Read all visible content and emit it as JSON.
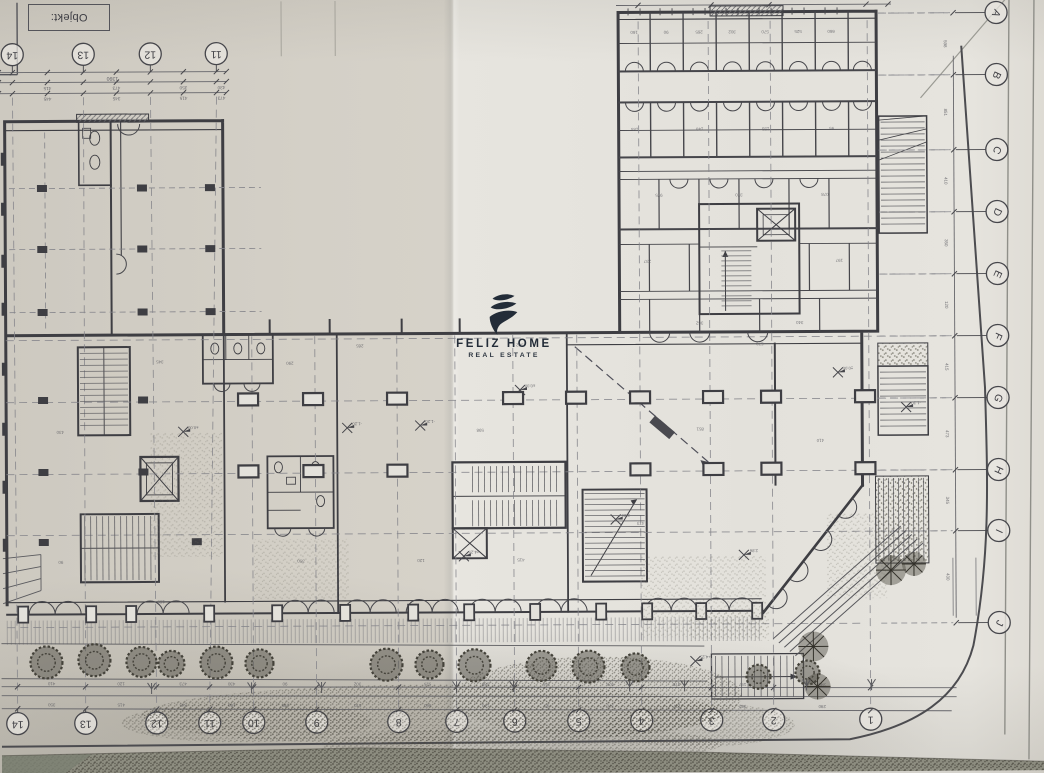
{
  "document": {
    "kind": "scanned architectural ground floor plan",
    "title_block": {
      "object_label": "Objekt:"
    },
    "watermark": {
      "line1": "FELIZ HOME",
      "line2": "REAL ESTATE"
    },
    "grid": {
      "top_columns": [
        {
          "label": "14",
          "x": 14
        },
        {
          "label": "13",
          "x": 85
        },
        {
          "label": "12",
          "x": 152
        },
        {
          "label": "11",
          "x": 218
        }
      ],
      "bottom_columns": [
        {
          "label": "14",
          "x": 16
        },
        {
          "label": "13",
          "x": 84
        },
        {
          "label": "12",
          "x": 155
        },
        {
          "label": "11",
          "x": 208
        },
        {
          "label": "10",
          "x": 252
        },
        {
          "label": "9",
          "x": 315
        },
        {
          "label": "8",
          "x": 397
        },
        {
          "label": "7",
          "x": 455
        },
        {
          "label": "6",
          "x": 513
        },
        {
          "label": "5",
          "x": 577
        },
        {
          "label": "4",
          "x": 640
        },
        {
          "label": "3",
          "x": 710
        },
        {
          "label": "2",
          "x": 772
        },
        {
          "label": "1",
          "x": 869
        }
      ],
      "rows": [
        {
          "label": "A",
          "y": 15
        },
        {
          "label": "B",
          "y": 77
        },
        {
          "label": "C",
          "y": 152
        },
        {
          "label": "D",
          "y": 214
        },
        {
          "label": "E",
          "y": 276
        },
        {
          "label": "F",
          "y": 338
        },
        {
          "label": "G",
          "y": 400
        },
        {
          "label": "H",
          "y": 472
        },
        {
          "label": "I",
          "y": 533
        },
        {
          "label": "J",
          "y": 625
        }
      ]
    },
    "dimensions": {
      "top_chain_total": "1390",
      "top_chain": [
        "415",
        "473",
        "350",
        "430",
        "445",
        "345"
      ],
      "scattered": [
        "410",
        "350",
        "120",
        "415",
        "473",
        "345",
        "430",
        "160",
        "90",
        "265",
        "302",
        "570",
        "525",
        "660",
        "185",
        "140",
        "155",
        "95",
        "975",
        "370",
        "078",
        "237",
        "197",
        "362",
        "340",
        "290",
        "598",
        "851"
      ],
      "levels": [
        "±0.00",
        "-1.20",
        "+4.25",
        "2.86"
      ]
    },
    "colors": {
      "paper_left": "#d4d0c7",
      "paper_right": "#e5e3dd",
      "ink": "#46464b",
      "ink_dark": "#3e3e43",
      "ink_light": "#84848a",
      "dim_text": "#5a5a60",
      "tree": "#44423a",
      "watermark": "#232c38",
      "table": "#8d8d80"
    }
  }
}
